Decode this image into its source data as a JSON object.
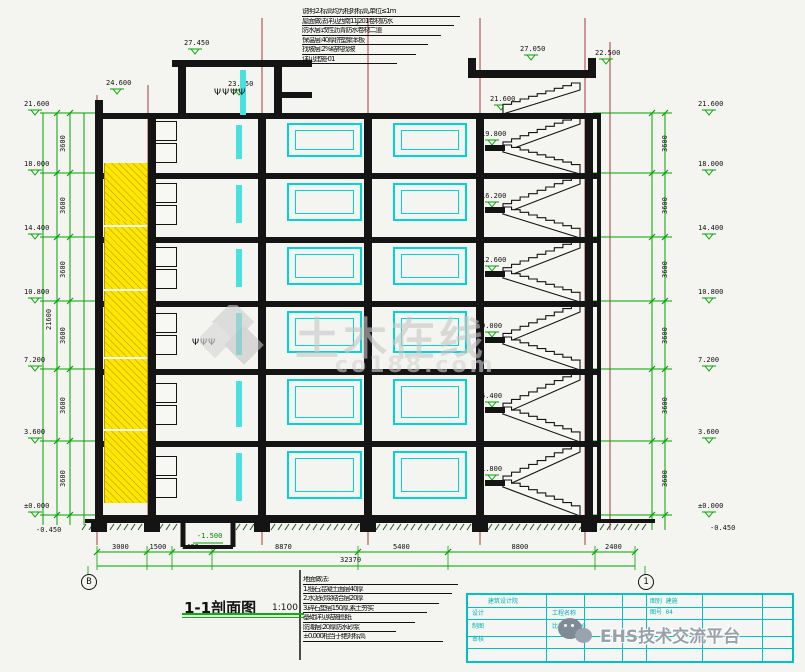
{
  "document": {
    "type": "architectural-section-drawing",
    "section_title": "1-1剖面图",
    "section_scale": "1:100"
  },
  "colors": {
    "background": "#f4f4f1",
    "dimension_green": "#00a400",
    "grid_red": "#a33a3a",
    "ink_black": "#141414",
    "window_cyan": "#00d4d4",
    "stair_yellow": "#ffe800",
    "titleblock_cyan": "#00c0c0",
    "watermark_gray": "#c7c7c7",
    "brand_gray": "#97a1aa"
  },
  "geometry": {
    "levels_y": [
      113,
      173,
      237,
      301,
      369,
      441,
      515
    ],
    "ground_y": 521,
    "columns_x": [
      95,
      148,
      258,
      364,
      476,
      585
    ],
    "shaft": {
      "x": 104,
      "w": 42
    },
    "window_bays": [
      [
        287,
        358
      ],
      [
        393,
        463
      ]
    ],
    "cyan_strip_x": 236,
    "stairs": {
      "x_left": 489,
      "x_right": 580
    },
    "grid_lines": [
      {
        "x": 97,
        "y1": 95,
        "y2": 545
      },
      {
        "x": 148,
        "y1": 85,
        "y2": 530
      },
      {
        "x": 262,
        "y1": 18,
        "y2": 545
      },
      {
        "x": 368,
        "y1": 18,
        "y2": 545
      },
      {
        "x": 480,
        "y1": 18,
        "y2": 545
      },
      {
        "x": 585,
        "y1": 18,
        "y2": 545
      },
      {
        "x": 610,
        "y1": 42,
        "y2": 530
      }
    ],
    "pit": {
      "x1": 183,
      "x2": 233,
      "bottom": 547
    }
  },
  "elevations": {
    "left": [
      "21.600",
      "18.000",
      "14.400",
      "10.800",
      "7.200",
      "3.600",
      "±0.000"
    ],
    "right": [
      "21.600",
      "18.000",
      "14.400",
      "10.800",
      "7.200",
      "3.600",
      "±0.000"
    ],
    "left_below": "-0.450",
    "right_below": "-0.450",
    "stair_landings": [
      "19.800",
      "16.200",
      "12.600",
      "9.000",
      "5.400",
      "1.800"
    ],
    "pit_label": "-1.500",
    "top_markers": [
      {
        "text": "27.450",
        "x": 186,
        "y": 42
      },
      {
        "text": "24.600",
        "x": 108,
        "y": 82
      },
      {
        "text": "23.850",
        "x": 230,
        "y": 83
      },
      {
        "text": "27.050",
        "x": 522,
        "y": 48
      },
      {
        "text": "22.500",
        "x": 597,
        "y": 52
      },
      {
        "text": "21.600",
        "x": 492,
        "y": 98
      }
    ]
  },
  "dimensions": {
    "floor_heights": [
      "3600",
      "3600",
      "3600",
      "3600",
      "3600",
      "3600"
    ],
    "total_height": "21600",
    "bottom_ticks_x": [
      97,
      147,
      172,
      212,
      358,
      448,
      595,
      635
    ],
    "bottom_values": [
      "3000",
      "1500",
      "2400",
      "8870",
      "5400",
      "8800",
      "2400"
    ],
    "bottom_total": "32370"
  },
  "grid_bubbles": [
    {
      "label": "B",
      "x": 88,
      "y": 581
    },
    {
      "label": "1",
      "x": 645,
      "y": 581
    }
  ],
  "notes_top": [
    "说明:2.标高均为相对标高,单位≤1m",
    "屋面做法详见西南11J201卷材防水",
    "防水层:改性沥青防水卷材二道",
    "保温层:40厚挤塑聚苯板",
    "找坡层:2%结构找坡",
    "详见建施-01"
  ],
  "notes_bottom": [
    "地面做法:",
    "1.细石混凝土面层40厚",
    "2.水泥砂浆结合层20厚",
    "3.碎石垫层150厚,素土夯实",
    "基础详见结施图纸",
    "防潮层:20厚防水砂浆",
    "±0.000相当于绝对标高"
  ],
  "watermark": {
    "line1": "土木在线",
    "line2": "co188.com"
  },
  "brand": {
    "text": "EHS技术交流平台",
    "logo": "wechat-icon"
  },
  "titleblock": {
    "left_cells": [
      "设计",
      "制图",
      "审核"
    ],
    "top_cell": "建筑设计院",
    "right_cells": [
      "图别 建施",
      "图号 04"
    ],
    "mid_cells": [
      "工程名称",
      "比例 1:100"
    ]
  },
  "figures_glyph": "ΨΨΨ"
}
